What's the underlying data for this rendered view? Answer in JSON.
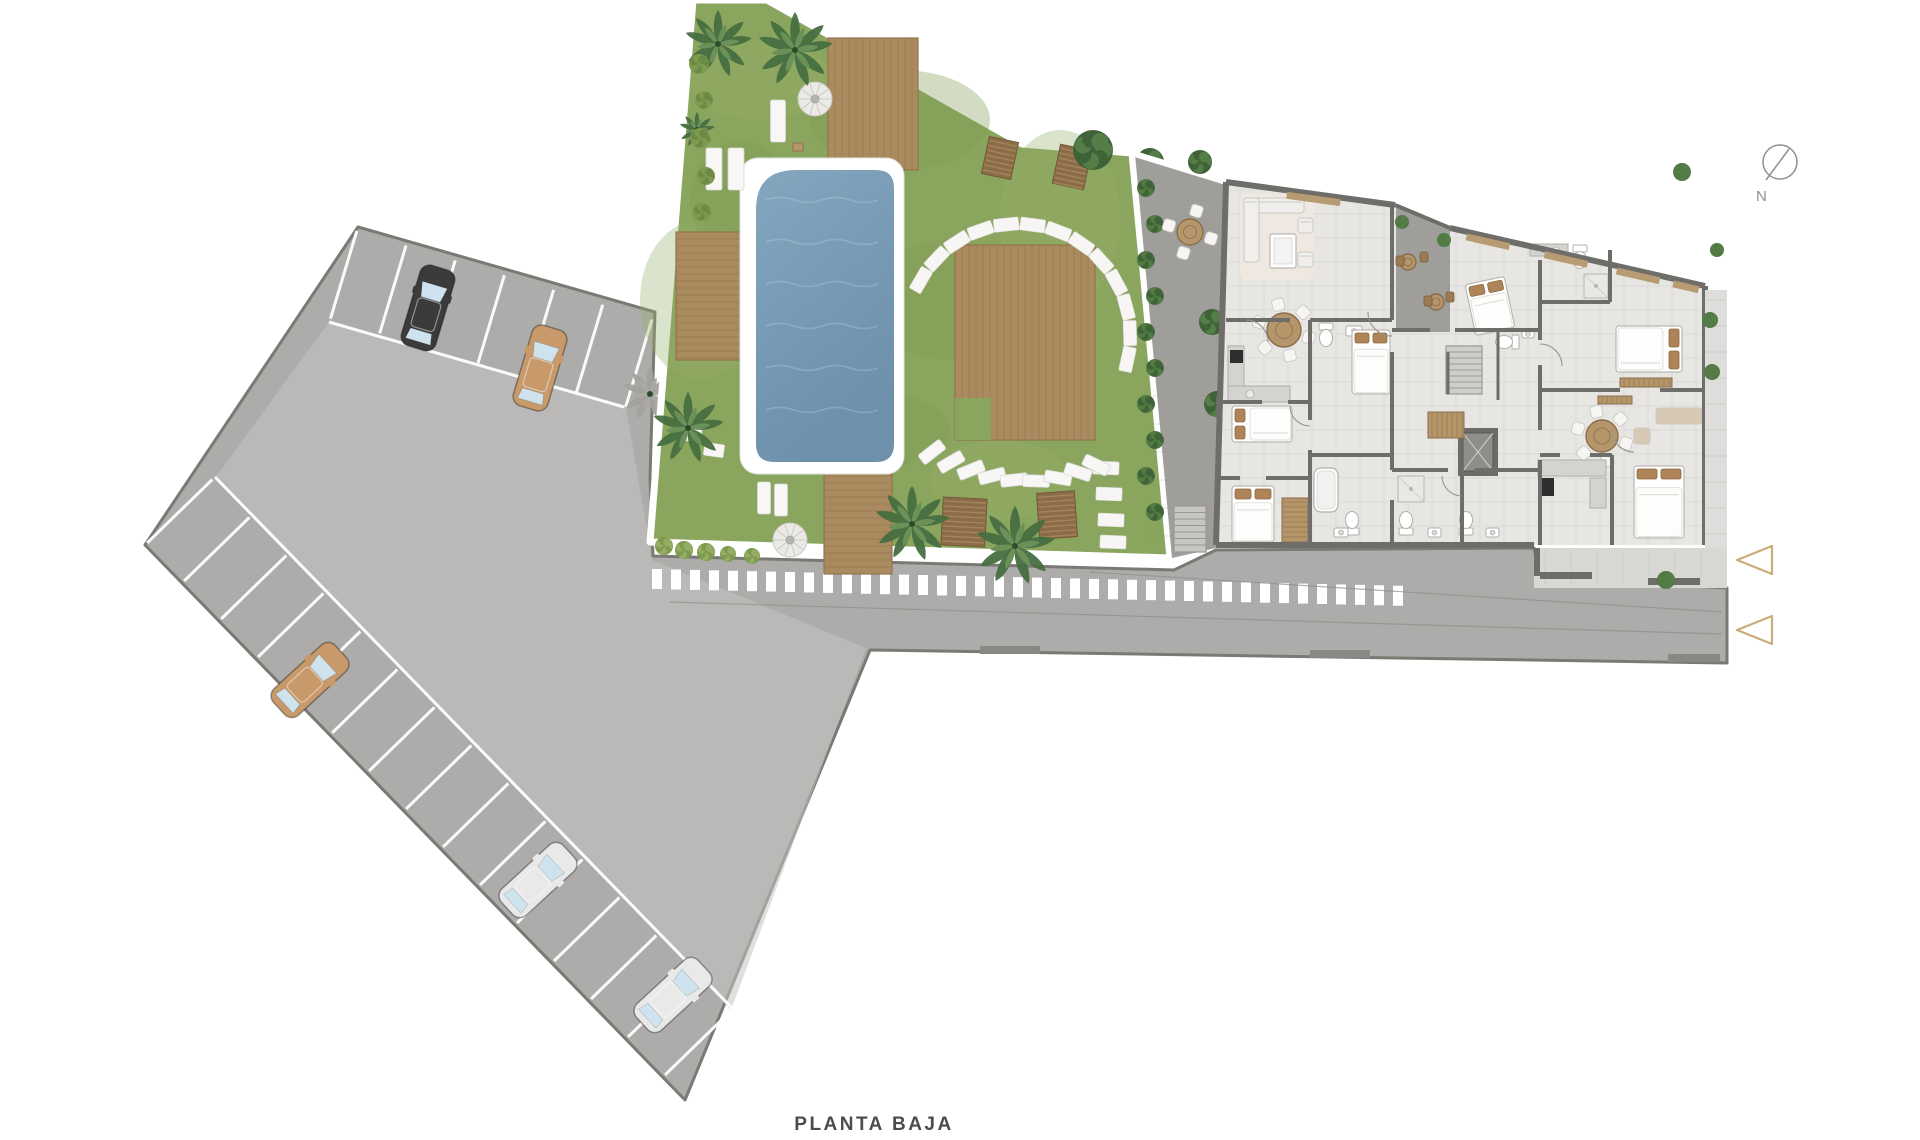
{
  "title": {
    "label": "PLANTA BAJA"
  },
  "compass": {
    "label": "N"
  },
  "palette": {
    "bg": "#ffffff",
    "asphalt": "#aeacaa",
    "asphalt_light": "#c6c4c1",
    "asphalt_border": "#7b7974",
    "grass": "#8aa55e",
    "grass_dark": "#7d9a51",
    "deck": "#aa8b60",
    "deck_line": "#93744c",
    "pool_light": "#84a6bf",
    "pool_dark": "#6d90ab",
    "terrace": "#a09e9a",
    "floor": "#e7e6e3",
    "tile": "#d6d5d2",
    "wall": "#6f6d69",
    "wood": "#b5966b",
    "wood_dark": "#8a6c48",
    "pillow": "#ad8357",
    "bush": "#527a43",
    "bush_light": "#7e9a4e",
    "palm_dark": "#476e40",
    "palm_light": "#6b9158",
    "triangle": "#c9ac7a",
    "compass": "#8f8f8f",
    "text": "#4c4c4c",
    "glass": "#cfe3ee"
  },
  "parking": {
    "stall_count_top": 6,
    "stall_count_bottom": 14,
    "cars": [
      {
        "id": "car-1",
        "body": "black",
        "color": "#3b3b3b"
      },
      {
        "id": "car-2",
        "body": "tan",
        "color": "#c89a6b"
      },
      {
        "id": "car-3",
        "body": "tan",
        "color": "#c89a6b"
      },
      {
        "id": "car-4",
        "body": "silver",
        "color": "#e9e9e9"
      },
      {
        "id": "car-5",
        "body": "silver",
        "color": "#e9e9e9"
      }
    ]
  },
  "navigation": {
    "arrows": [
      {
        "id": "nav-arrow-1"
      },
      {
        "id": "nav-arrow-2"
      }
    ]
  }
}
